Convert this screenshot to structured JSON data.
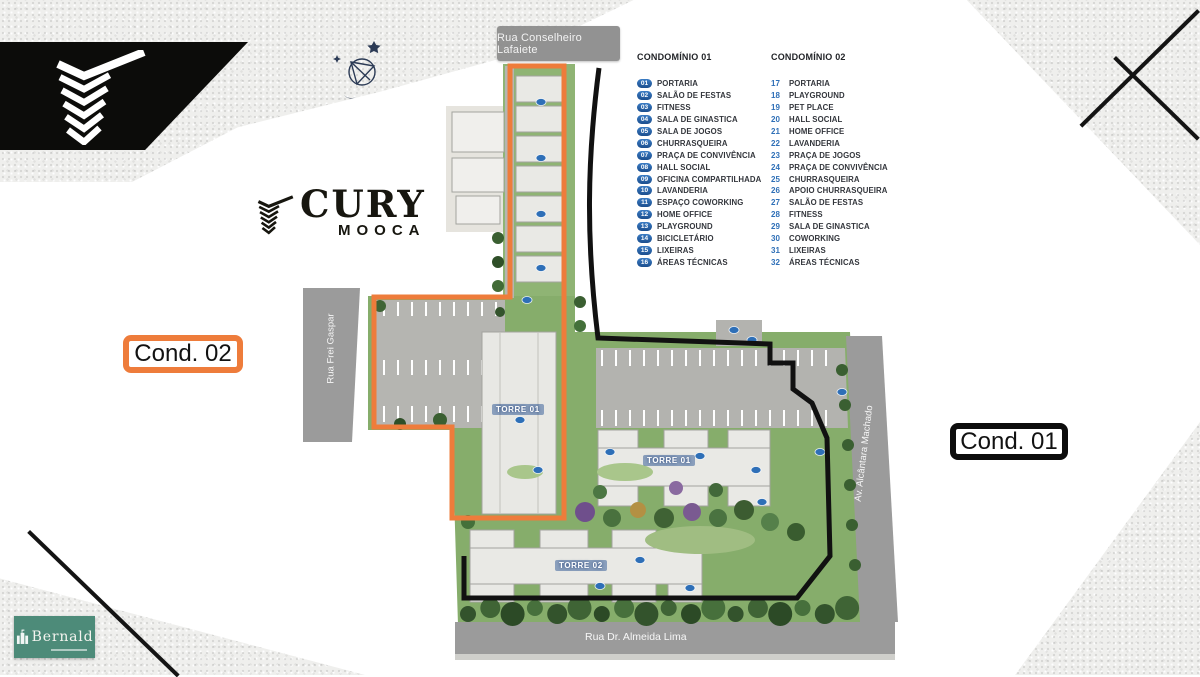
{
  "branding": {
    "cury": {
      "title": "CURY",
      "subtitle": "MOOCA"
    },
    "bernald": {
      "name": "Bernald"
    }
  },
  "map": {
    "streets": {
      "top": "Rua Conselheiro Lafaiete",
      "left": "Rua Frei Gaspar",
      "right": "Av. Alcântara Machado",
      "bottom": "Rua Dr. Almeida Lima"
    },
    "towers": {
      "cond02_tower": "TORRE 01",
      "cond01_tower1": "TORRE 01",
      "cond01_tower2": "TORRE 02"
    },
    "area_labels": {
      "cond01": "Cond. 01",
      "cond02": "Cond. 02"
    }
  },
  "legend": {
    "col1": {
      "title": "CONDOMÍNIO 01",
      "items": [
        {
          "n": "01",
          "t": "PORTARIA"
        },
        {
          "n": "02",
          "t": "SALÃO DE FESTAS"
        },
        {
          "n": "03",
          "t": "FITNESS"
        },
        {
          "n": "04",
          "t": "SALA DE GINASTICA"
        },
        {
          "n": "05",
          "t": "SALA DE JOGOS"
        },
        {
          "n": "06",
          "t": "CHURRASQUEIRA"
        },
        {
          "n": "07",
          "t": "PRAÇA DE CONVIVÊNCIA"
        },
        {
          "n": "08",
          "t": "HALL SOCIAL"
        },
        {
          "n": "09",
          "t": "OFICINA COMPARTILHADA"
        },
        {
          "n": "10",
          "t": "LAVANDERIA"
        },
        {
          "n": "11",
          "t": "ESPAÇO COWORKING"
        },
        {
          "n": "12",
          "t": "HOME OFFICE"
        },
        {
          "n": "13",
          "t": "PLAYGROUND"
        },
        {
          "n": "14",
          "t": "BICICLETÁRIO"
        },
        {
          "n": "15",
          "t": "LIXEIRAS"
        },
        {
          "n": "16",
          "t": "ÁREAS TÉCNICAS"
        }
      ]
    },
    "col2": {
      "title": "CONDOMÍNIO 02",
      "items": [
        {
          "n": "17",
          "t": "PORTARIA"
        },
        {
          "n": "18",
          "t": "PLAYGROUND"
        },
        {
          "n": "19",
          "t": "PET PLACE"
        },
        {
          "n": "20",
          "t": "HALL SOCIAL"
        },
        {
          "n": "21",
          "t": "HOME OFFICE"
        },
        {
          "n": "22",
          "t": "LAVANDERIA"
        },
        {
          "n": "23",
          "t": "PRAÇA DE JOGOS"
        },
        {
          "n": "24",
          "t": "PRAÇA DE CONVIVÊNCIA"
        },
        {
          "n": "25",
          "t": "CHURRASQUEIRA"
        },
        {
          "n": "26",
          "t": "APOIO CHURRASQUEIRA"
        },
        {
          "n": "27",
          "t": "SALÃO DE FESTAS"
        },
        {
          "n": "28",
          "t": "FITNESS"
        },
        {
          "n": "29",
          "t": "SALA DE GINASTICA"
        },
        {
          "n": "30",
          "t": "COWORKING"
        },
        {
          "n": "31",
          "t": "LIXEIRAS"
        },
        {
          "n": "32",
          "t": "ÁREAS TÉCNICAS"
        }
      ]
    }
  },
  "colors": {
    "accent_orange": "#ee7c3b",
    "boundary_black": "#111111",
    "legend_blue": "#2e6fb7",
    "bernald_green": "#4d8b79",
    "road_gray": "#9b9b9b"
  }
}
